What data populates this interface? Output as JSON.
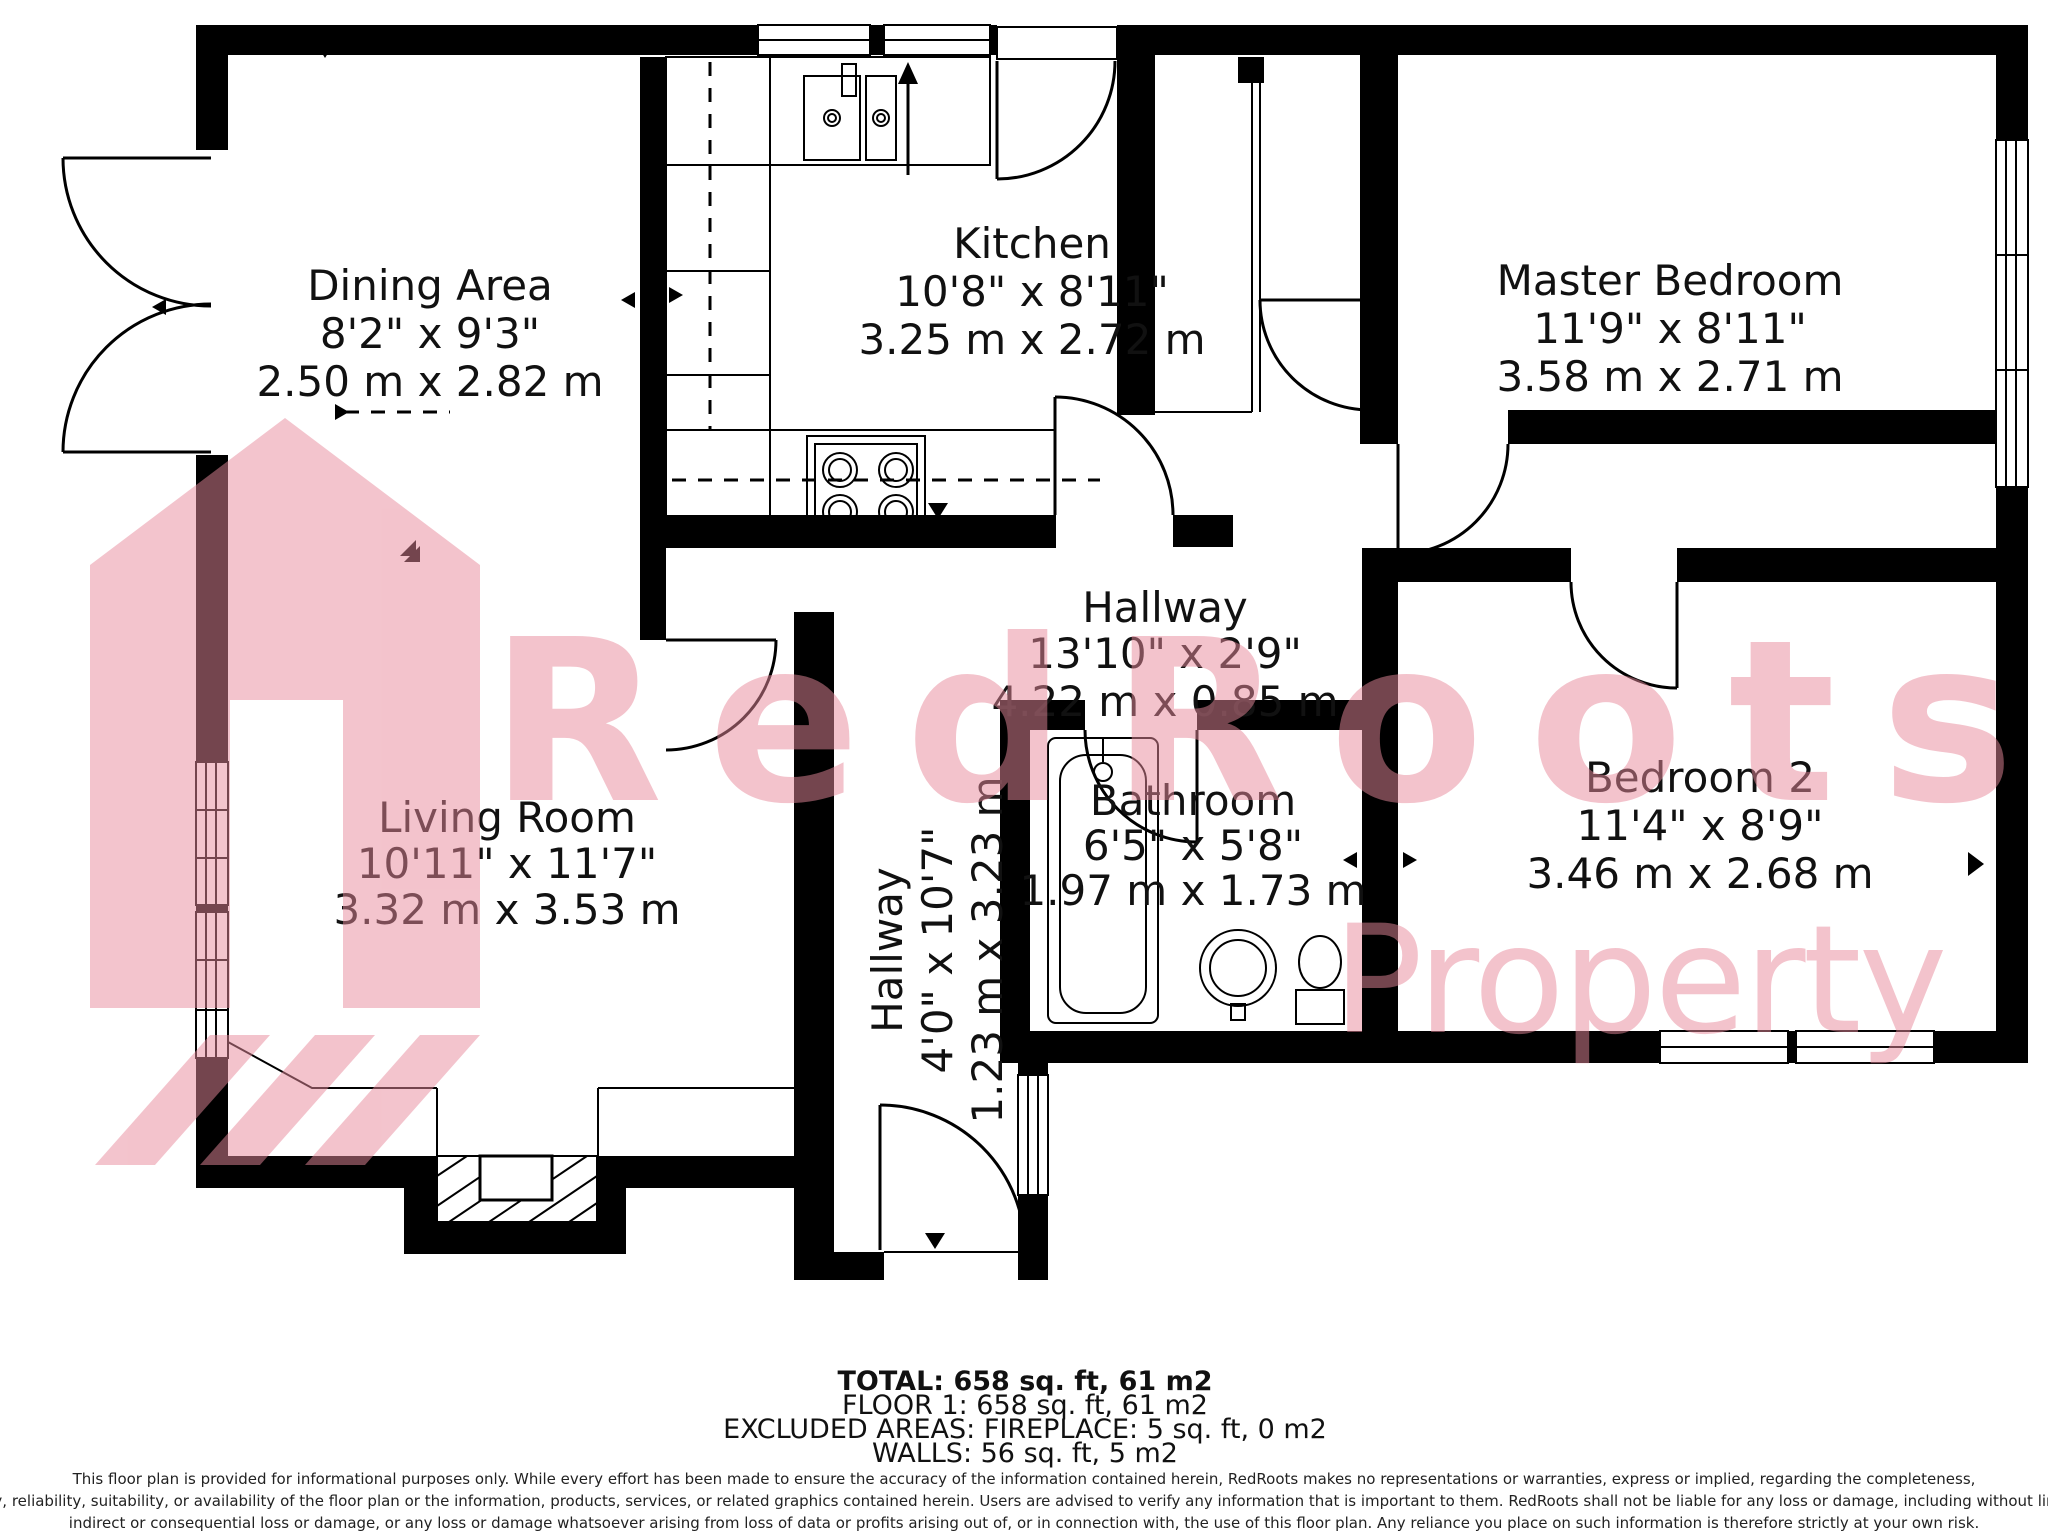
{
  "watermark": {
    "brand": "RedRoots",
    "sub": "Property",
    "color": "#e8899b"
  },
  "rooms": [
    {
      "name": "Dining Area",
      "imperial": "8'2\" x 9'3\"",
      "metric": "2.50 m x 2.82 m"
    },
    {
      "name": "Kitchen",
      "imperial": "10'8\" x 8'11\"",
      "metric": "3.25 m x 2.72 m"
    },
    {
      "name": "Master Bedroom",
      "imperial": "11'9\" x 8'11\"",
      "metric": "3.58 m x 2.71 m"
    },
    {
      "name": "Hallway",
      "imperial": "13'10\" x 2'9\"",
      "metric": "4.22 m x 0.85 m"
    },
    {
      "name": "Living Room",
      "imperial": "10'11\" x 11'7\"",
      "metric": "3.32 m x 3.53 m"
    },
    {
      "name": "Hallway",
      "imperial": "4'0\" x 10'7\"",
      "metric": "1.23 m x 3.23 m"
    },
    {
      "name": "Bathroom",
      "imperial": "6'5\" x 5'8\"",
      "metric": "1.97 m x 1.73 m"
    },
    {
      "name": "Bedroom 2",
      "imperial": "11'4\" x 8'9\"",
      "metric": "3.46 m x 2.68 m"
    }
  ],
  "summary": {
    "total": "TOTAL: 658 sq. ft, 61 m2",
    "floor1": "FLOOR 1: 658 sq. ft, 61 m2",
    "excluded": "EXCLUDED AREAS: FIREPLACE: 5 sq. ft, 0 m2",
    "walls": "WALLS: 56 sq. ft, 5 m2"
  },
  "disclaimer": {
    "line1": "This floor plan is provided for informational purposes only. While every effort has been made to ensure the accuracy of the information contained herein, RedRoots makes no representations or warranties, express or implied, regarding the completeness,",
    "line2": "accuracy, reliability, suitability, or availability of the floor plan or the information, products, services, or related graphics contained herein. Users are advised to verify any information that is important to them. RedRoots shall not be liable for any loss or damage, including without limitation,",
    "line3": "indirect or consequential loss or damage, or any loss or damage whatsoever arising from loss of data or profits arising out of, or in connection with, the use of this floor plan. Any reliance you place on such information is therefore strictly at your own risk."
  }
}
